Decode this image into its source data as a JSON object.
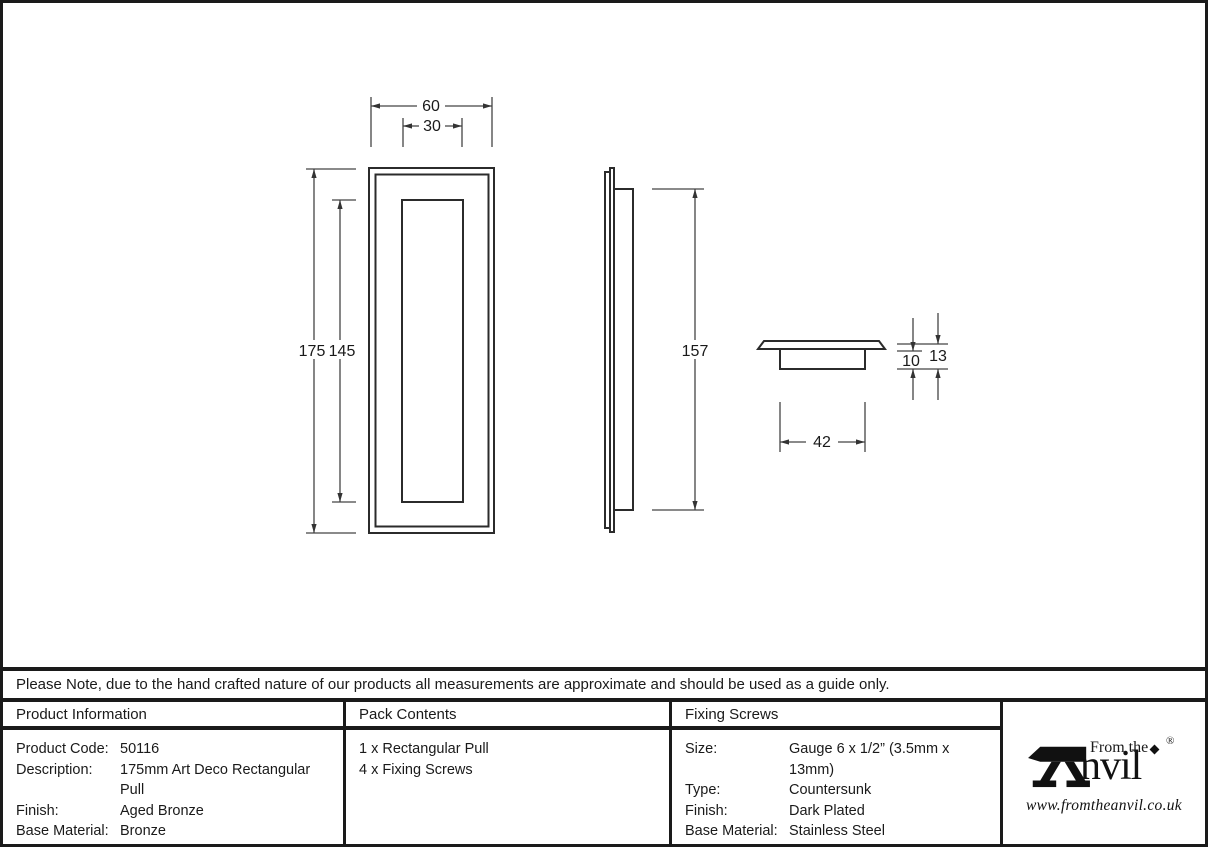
{
  "drawing": {
    "dims": {
      "outer_width": "60",
      "inner_width": "30",
      "outer_height": "175",
      "inner_height": "145",
      "recess_height": "157",
      "base_width": "42",
      "base_depth": "10",
      "total_depth": "13"
    }
  },
  "note": "Please Note, due to the hand crafted nature of our products all measurements are approximate and should be used as a guide only.",
  "table": {
    "product_information": {
      "header": "Product Information",
      "rows": [
        {
          "label": "Product Code:",
          "value": "50116"
        },
        {
          "label": "Description:",
          "value": "175mm Art Deco Rectangular Pull"
        },
        {
          "label": "Finish:",
          "value": "Aged Bronze"
        },
        {
          "label": "Base Material:",
          "value": "Bronze"
        }
      ]
    },
    "pack_contents": {
      "header": "Pack Contents",
      "items": [
        "1 x Rectangular Pull",
        "4 x Fixing Screws"
      ]
    },
    "fixing_screws": {
      "header": "Fixing Screws",
      "rows": [
        {
          "label": "Size:",
          "value": "Gauge 6 x 1/2” (3.5mm x 13mm)"
        },
        {
          "label": "Type:",
          "value": "Countersunk"
        },
        {
          "label": "Finish:",
          "value": "Dark Plated"
        },
        {
          "label": "Base Material:",
          "value": "Stainless Steel"
        }
      ]
    }
  },
  "logo": {
    "from_the": "From the",
    "name_rest": "nvil",
    "registered": "®",
    "url": "www.fromtheanvil.co.uk"
  }
}
